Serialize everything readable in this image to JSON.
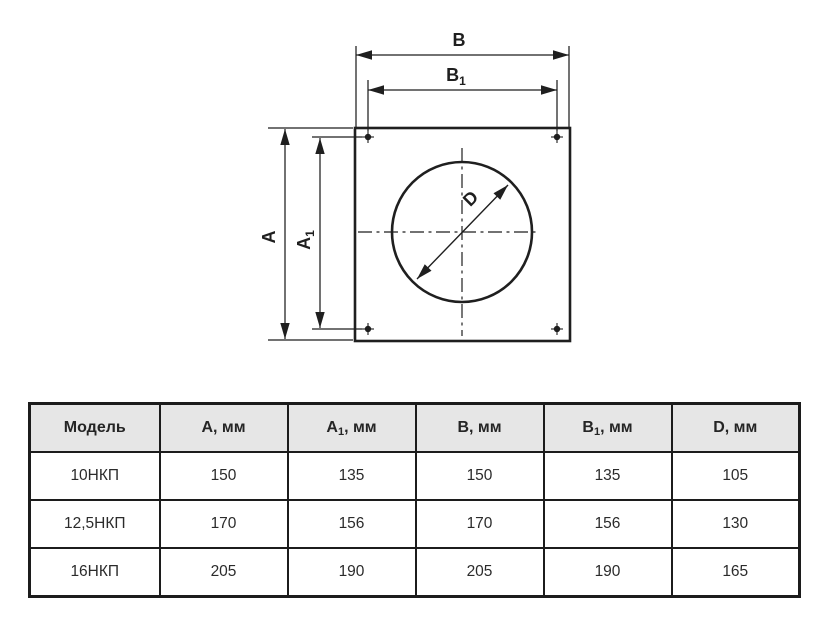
{
  "colors": {
    "ink": "#1f1f1f",
    "table_border": "#1c1c1c",
    "header_bg": "#e6e6e6",
    "background": "#ffffff"
  },
  "drawing": {
    "labels": {
      "b": {
        "pre": "B",
        "sub": ""
      },
      "b1": {
        "pre": "B",
        "sub": "1"
      },
      "a": {
        "pre": "A",
        "sub": ""
      },
      "a1": {
        "pre": "A",
        "sub": "1"
      },
      "d": {
        "pre": "D",
        "sub": ""
      }
    }
  },
  "table": {
    "columns": [
      {
        "pre": "Модель",
        "sub": "",
        "post": ""
      },
      {
        "pre": "А",
        "sub": "",
        "post": ", мм"
      },
      {
        "pre": "А",
        "sub": "1",
        "post": ", мм"
      },
      {
        "pre": "В",
        "sub": "",
        "post": ", мм"
      },
      {
        "pre": "В",
        "sub": "1",
        "post": ", мм"
      },
      {
        "pre": "D",
        "sub": "",
        "post": ", мм"
      }
    ],
    "rows": [
      {
        "model": "10НКП",
        "a": "150",
        "a1": "135",
        "b": "150",
        "b1": "135",
        "d": "105"
      },
      {
        "model": "12,5НКП",
        "a": "170",
        "a1": "156",
        "b": "170",
        "b1": "156",
        "d": "130"
      },
      {
        "model": "16НКП",
        "a": "205",
        "a1": "190",
        "b": "205",
        "b1": "190",
        "d": "165"
      }
    ]
  }
}
